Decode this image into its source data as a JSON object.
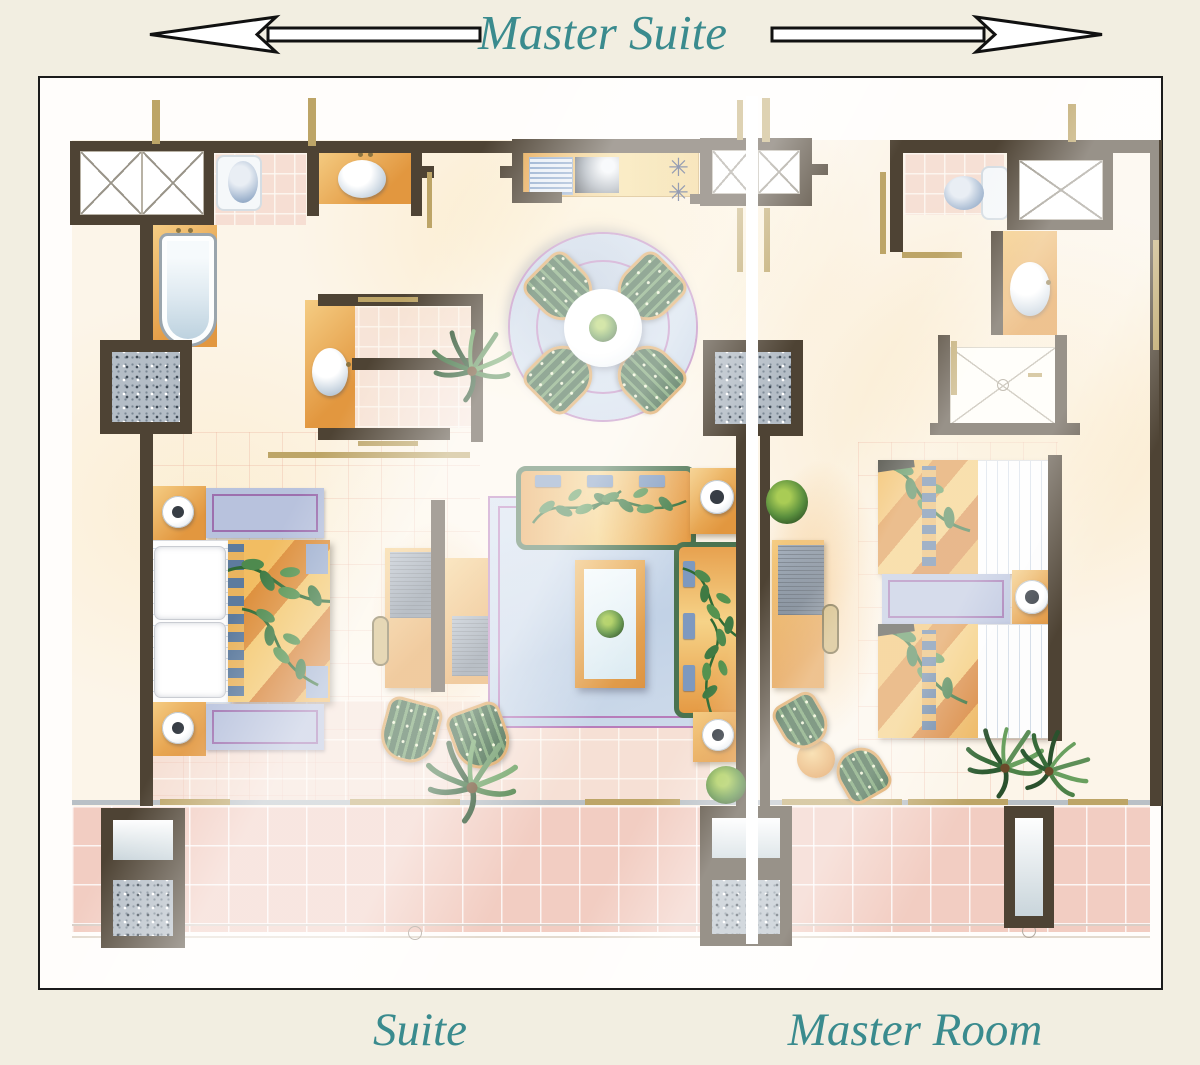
{
  "header": {
    "title": "Master Suite",
    "left_arrow_icon": "arrow-left",
    "right_arrow_icon": "arrow-right"
  },
  "footer": {
    "suite_label": "Suite",
    "master_room_label": "Master Room"
  },
  "kitchen": {
    "burner_glyph": "✳"
  },
  "colors": {
    "page_bg": "#f2eee1",
    "panel_bg": "#fffdfb",
    "panel_border": "#1b1b1b",
    "teal": "#3a8b8e",
    "wall": "#4e4334",
    "tan": "#bda567",
    "orange": "#e2973f",
    "orange_light": "#f5cd84",
    "lavender": "#b8c2dd",
    "purple": "#9d6fae",
    "rug_blue": "#c9d7e8",
    "rug_ring": "#b77cba",
    "pink_tile": "#f2cdc2",
    "cream": "#fcf5e9",
    "burner": "#2b3a66"
  }
}
